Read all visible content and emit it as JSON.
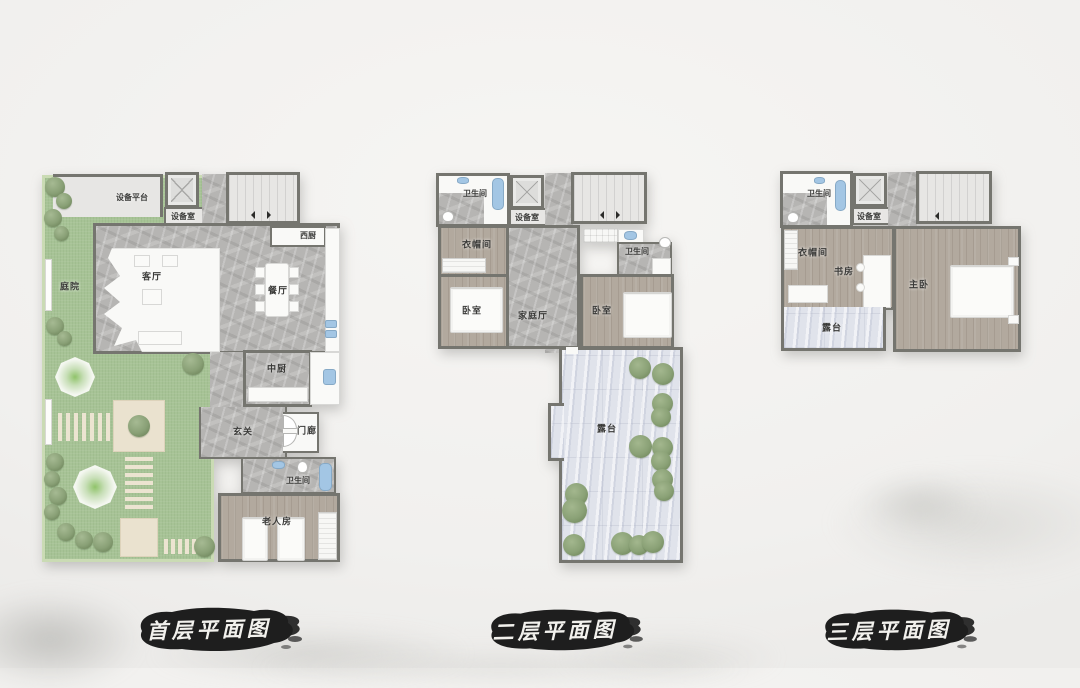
{
  "page": {
    "background": "#f1f0ee",
    "style": "ink-wash architectural presentation, three villa floor plans"
  },
  "colors": {
    "wall": "#75756f",
    "grass": "#a7c396",
    "stone": "#b6b5b3",
    "wood": "#b2a99e",
    "terrace": "#e0e3eb",
    "room_white": "#f9f9f7",
    "room_light": "#e7e6e4",
    "fixture_blue": "#a3c6e4",
    "bush_green": "#8aa176",
    "ink": "#1e1e1e",
    "title_text": "#f2f1ed"
  },
  "plans": [
    {
      "id": "first-floor",
      "title": "首层平面图",
      "rooms": [
        {
          "key": "equipment-platform",
          "label": "设备平台"
        },
        {
          "key": "equipment-room",
          "label": "设备室"
        },
        {
          "key": "west-kitchen",
          "label": "西厨"
        },
        {
          "key": "living-room",
          "label": "客厅"
        },
        {
          "key": "dining-room",
          "label": "餐厅"
        },
        {
          "key": "courtyard",
          "label": "庭院"
        },
        {
          "key": "chinese-kitchen",
          "label": "中厨"
        },
        {
          "key": "entry-hall",
          "label": "玄关"
        },
        {
          "key": "porch",
          "label": "门廊"
        },
        {
          "key": "bathroom",
          "label": "卫生间"
        },
        {
          "key": "elderly-room",
          "label": "老人房"
        }
      ]
    },
    {
      "id": "second-floor",
      "title": "二层平面图",
      "rooms": [
        {
          "key": "bathroom-left",
          "label": "卫生间"
        },
        {
          "key": "equipment-room",
          "label": "设备室"
        },
        {
          "key": "cloakroom",
          "label": "衣帽间"
        },
        {
          "key": "bedroom-left",
          "label": "卧室"
        },
        {
          "key": "family-hall",
          "label": "家庭厅"
        },
        {
          "key": "bathroom-right",
          "label": "卫生间"
        },
        {
          "key": "bedroom-right",
          "label": "卧室"
        },
        {
          "key": "terrace",
          "label": "露台"
        }
      ]
    },
    {
      "id": "third-floor",
      "title": "三层平面图",
      "rooms": [
        {
          "key": "bathroom",
          "label": "卫生间"
        },
        {
          "key": "equipment-room",
          "label": "设备室"
        },
        {
          "key": "cloakroom",
          "label": "衣帽间"
        },
        {
          "key": "study",
          "label": "书房"
        },
        {
          "key": "master-bedroom",
          "label": "主卧"
        },
        {
          "key": "terrace",
          "label": "露台"
        }
      ]
    }
  ]
}
